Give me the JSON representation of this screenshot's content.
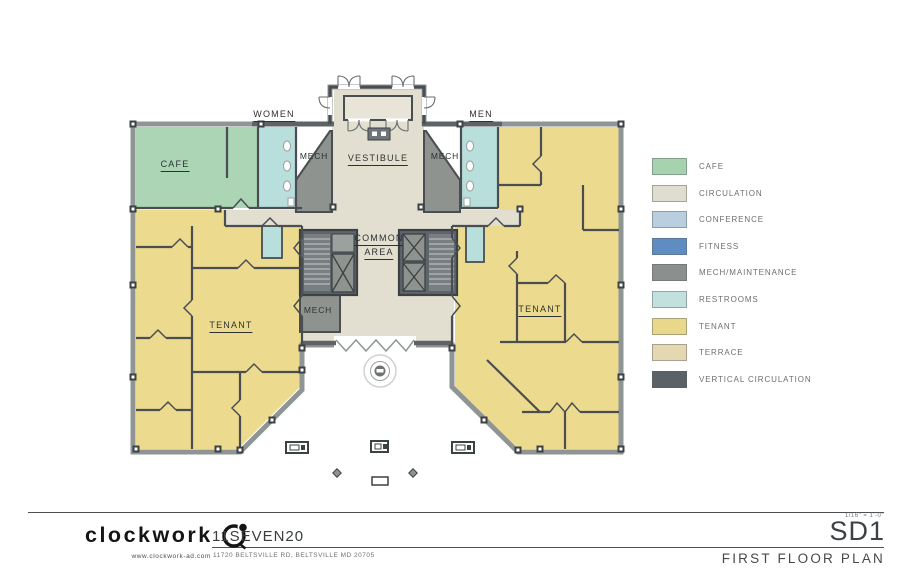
{
  "plan": {
    "labels": {
      "women": "WOMEN",
      "men": "MEN",
      "cafe": "CAFE",
      "mech_left": "MECH",
      "vestibule": "VESTIBULE",
      "mech_right": "MECH",
      "common_line1": "COMMON",
      "common_line2": "AREA",
      "mech_lower": "MECH",
      "tenant_left": "TENANT",
      "tenant_right": "TENANT"
    },
    "colors": {
      "wall": "#4a4e52",
      "exterior_wall": "#8f9595",
      "cafe": "#abd5b4",
      "circulation": "#e2dfd1",
      "restrooms": "#b9dfdc",
      "tenant": "#ecdb8e",
      "mech": "#8e938f",
      "vertical_circulation": "#5e656b"
    }
  },
  "legend": {
    "items": [
      {
        "label": "CAFE",
        "color": "#a7d2b0"
      },
      {
        "label": "CIRCULATION",
        "color": "#dfddcf"
      },
      {
        "label": "CONFERENCE",
        "color": "#b9cfdf"
      },
      {
        "label": "FITNESS",
        "color": "#5e8ec1"
      },
      {
        "label": "MECH/MAINTENANCE",
        "color": "#8b908e"
      },
      {
        "label": "RESTROOMS",
        "color": "#c2e1de"
      },
      {
        "label": "TENANT",
        "color": "#e9d78a"
      },
      {
        "label": "TERRACE",
        "color": "#e5d7b2"
      },
      {
        "label": "VERTICAL CIRCULATION",
        "color": "#5b6167"
      }
    ]
  },
  "title_block": {
    "firm_name": "clockwork",
    "firm_website": "www.clockwork-ad.com",
    "project_name": "11SEVEN20",
    "project_address": "11720 BELTSVILLE RD, BELTSVILLE MD 20705",
    "scale": "1/16\" = 1'-0\"",
    "sheet_number": "SD1",
    "sheet_title": "FIRST FLOOR PLAN"
  }
}
